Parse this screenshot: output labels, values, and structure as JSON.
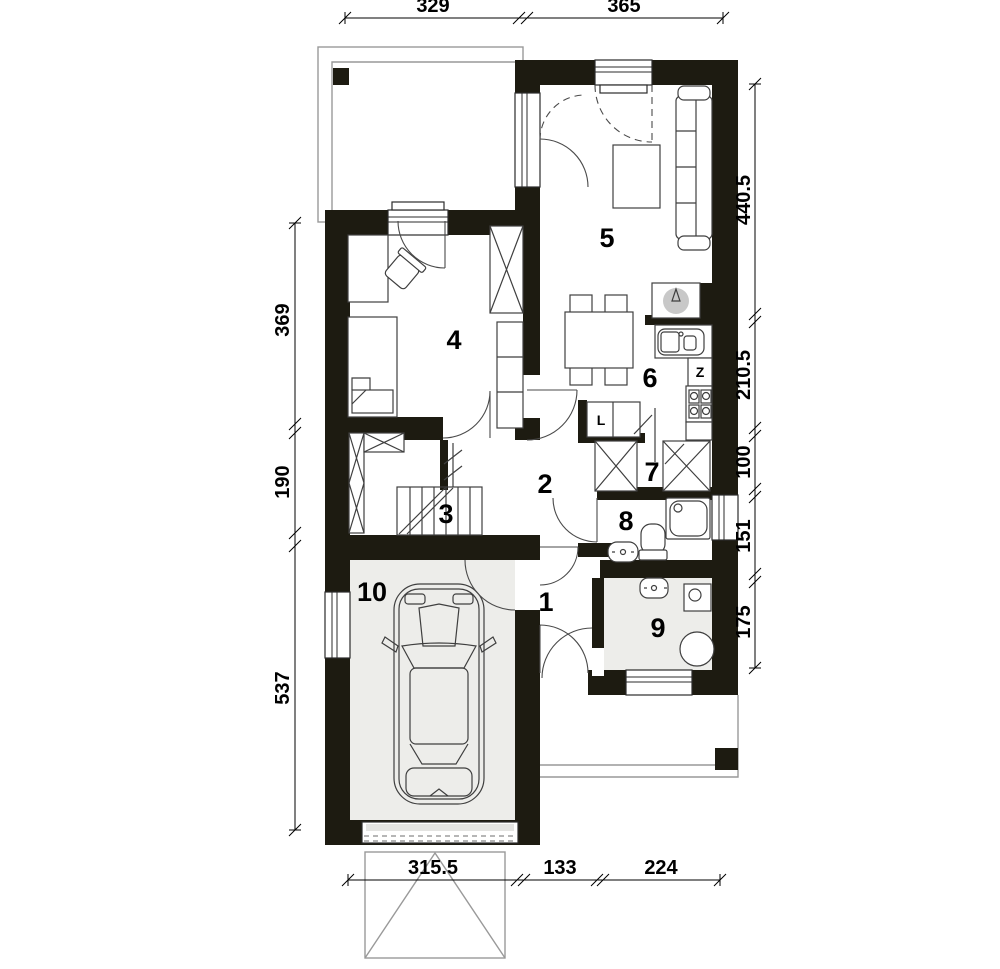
{
  "colors": {
    "wall": "#1d1b11",
    "floor": "#ededea",
    "fixgray": "#c8c8c8",
    "outline": "#999999",
    "fxstroke": "#3f3f3f"
  },
  "room_labels": {
    "r1": "1",
    "r2": "2",
    "r3": "3",
    "r4": "4",
    "r5": "5",
    "r6": "6",
    "r7": "7",
    "r8": "8",
    "r9": "9",
    "r10": "10"
  },
  "appliance_labels": {
    "fridge": "L",
    "dishwasher": "Z"
  },
  "dimensions": {
    "top": [
      "329",
      "365"
    ],
    "right": [
      "440.5",
      "210.5",
      "100",
      "151",
      "175"
    ],
    "left": [
      "369",
      "190",
      "537"
    ],
    "bottom": [
      "315.5",
      "133",
      "224"
    ]
  }
}
